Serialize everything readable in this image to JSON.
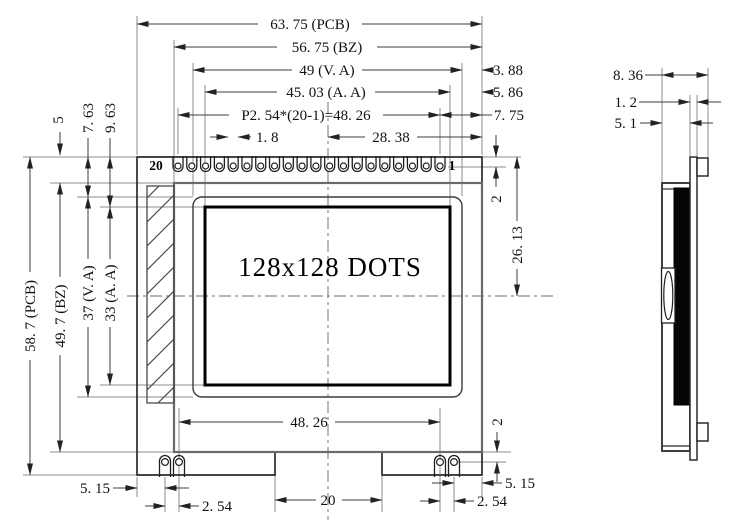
{
  "front_view": {
    "display_area_text": "128x128 DOTS",
    "pin_number_left": "20",
    "pin_number_right": "1",
    "top_pin_count": 20,
    "bottom_pin_count": 4,
    "dimensions": {
      "pcb_width": "63. 75 (PCB)",
      "bezel_width": "56. 75 (BZ)",
      "va_width": "49 (V. A)",
      "aa_width": "45. 03 (A. A)",
      "pin_pitch": "P2. 54*(20-1)=48. 26",
      "pad_width": "1. 8",
      "center_to_right": "28. 38",
      "va_right_margin": "3. 88",
      "aa_right_margin": "5. 86",
      "pin1_right_margin": "7. 75",
      "top_hole_offset": "2",
      "top_to_centerline": "26. 13",
      "pcb_height": "58. 7 (PCB)",
      "bezel_height": "49. 7 (BZ)",
      "va_height": "37 (V. A)",
      "aa_height": "33 (A. A)",
      "bezel_top_offset": "5",
      "va_top_offset": "7. 63",
      "aa_top_offset": "9. 63",
      "bottom_pin_span": "48. 26",
      "bottom_left_margin": "5. 15",
      "bottom_left_pitch": "2. 54",
      "notch_width": "20",
      "bottom_right_pitch": "2. 54",
      "bottom_right_margin": "5. 15",
      "bottom_hole_offset": "2"
    }
  },
  "side_view": {
    "dimensions": {
      "total_thickness": "8. 36",
      "pcb_thickness": "1. 2",
      "front_thickness": "5. 1"
    }
  }
}
